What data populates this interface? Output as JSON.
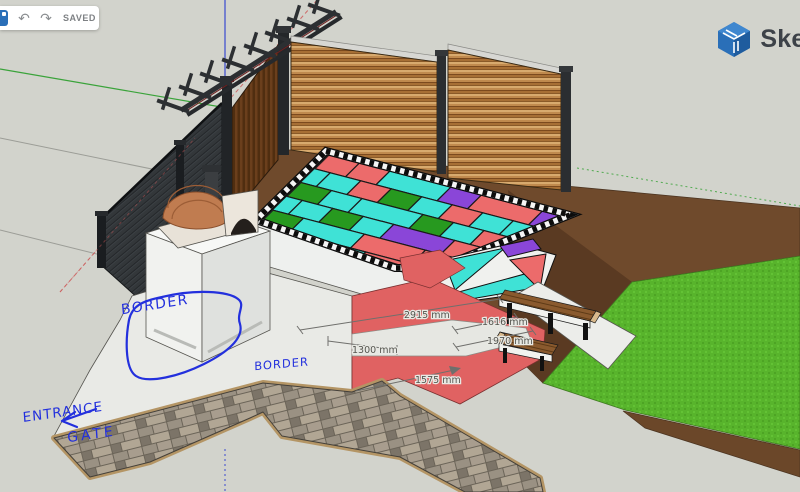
{
  "toolbar": {
    "saved_label": "SAVED",
    "undo_icon": "↶",
    "redo_icon": "↷"
  },
  "brand": {
    "logo_text": "Sket"
  },
  "viewport": {
    "dimensions": {
      "d1": {
        "label": "2915 mm"
      },
      "d2": {
        "label": "1616 mm"
      },
      "d3": {
        "label": "1300 mm"
      },
      "d4": {
        "label": "1970 mm"
      },
      "d5": {
        "label": "1575 mm"
      }
    },
    "annotations": {
      "border_upper": "BORDER",
      "border_lower": "BORDER",
      "entrance_line1": "ENTRANCE",
      "entrance_line2": "GATE"
    }
  },
  "colors": {
    "canvas": "#d2d3cc",
    "ink_blue": "#2330dd",
    "tile_palette": [
      "#3fe2d6",
      "#ec6b6b",
      "#8a46d8",
      "#27991f"
    ],
    "tile_grout": "#1a1a1a",
    "grass_green": "#58b42c",
    "dirt_brown": "#6f4a2c",
    "dirt_slope": "#5a3a22",
    "terrace_red": "#e06262",
    "fence_wood": "#a96f35",
    "axis_green": "#3aa33a",
    "axis_blue": "#3a4ad0",
    "axis_red": "#cc5555",
    "logo_blue": "#2a6fb8",
    "dim_text": "#55554f"
  }
}
